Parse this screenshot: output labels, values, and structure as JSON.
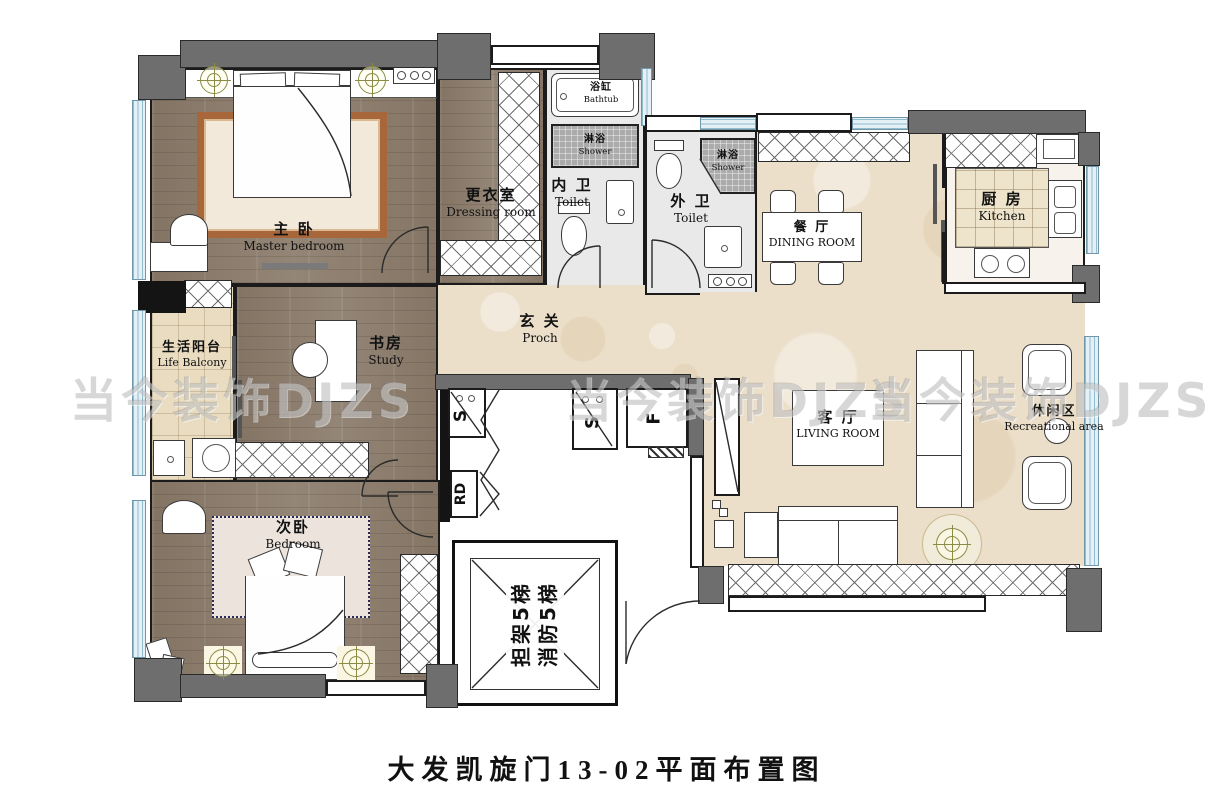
{
  "title": "大发凯旋门13-02平面布置图",
  "watermark": {
    "text": "当今装饰DJZS"
  },
  "rooms": {
    "master_bedroom": {
      "zh": "主 卧",
      "en": "Master bedroom"
    },
    "dressing_room": {
      "zh": "更衣室",
      "en": "Dressing room"
    },
    "inner_toilet": {
      "zh": "内 卫",
      "en": "Toilet"
    },
    "outer_toilet": {
      "zh": "外 卫",
      "en": "Toilet"
    },
    "dining_room": {
      "zh": "餐 厅",
      "en": "DINING ROOM"
    },
    "kitchen": {
      "zh": "厨 房",
      "en": "Kitchen"
    },
    "entrance": {
      "zh": "玄 关",
      "en": "Proch"
    },
    "study": {
      "zh": "书房",
      "en": "Study"
    },
    "life_balcony": {
      "zh": "生活阳台",
      "en": "Life Balcony"
    },
    "second_bedroom": {
      "zh": "次卧",
      "en": "Bedroom"
    },
    "living_room": {
      "zh": "客 厅",
      "en": "LIVING ROOM"
    },
    "recreational_area": {
      "zh": "休闲区",
      "en": "Recreational area"
    }
  },
  "fixtures": {
    "bathtub": {
      "zh": "浴缸",
      "en": "Bathtub"
    },
    "shower": {
      "zh": "淋浴",
      "en": "Shower"
    }
  },
  "elevator": {
    "line1": "担架5梯",
    "line2": "消防5梯"
  },
  "shafts": {
    "s": "S",
    "rd": "RD",
    "f": "F"
  },
  "colors": {
    "wall_gray": "#6e6e6e",
    "wall_black": "#141414",
    "window_blue": "#e3f1f7",
    "wood_floor": "#8d7e6e",
    "marble_beige": "#ebdfca",
    "rug_border": "#a8673b",
    "shower_tile": "#ababab",
    "light_accent": "#8b8b45"
  }
}
